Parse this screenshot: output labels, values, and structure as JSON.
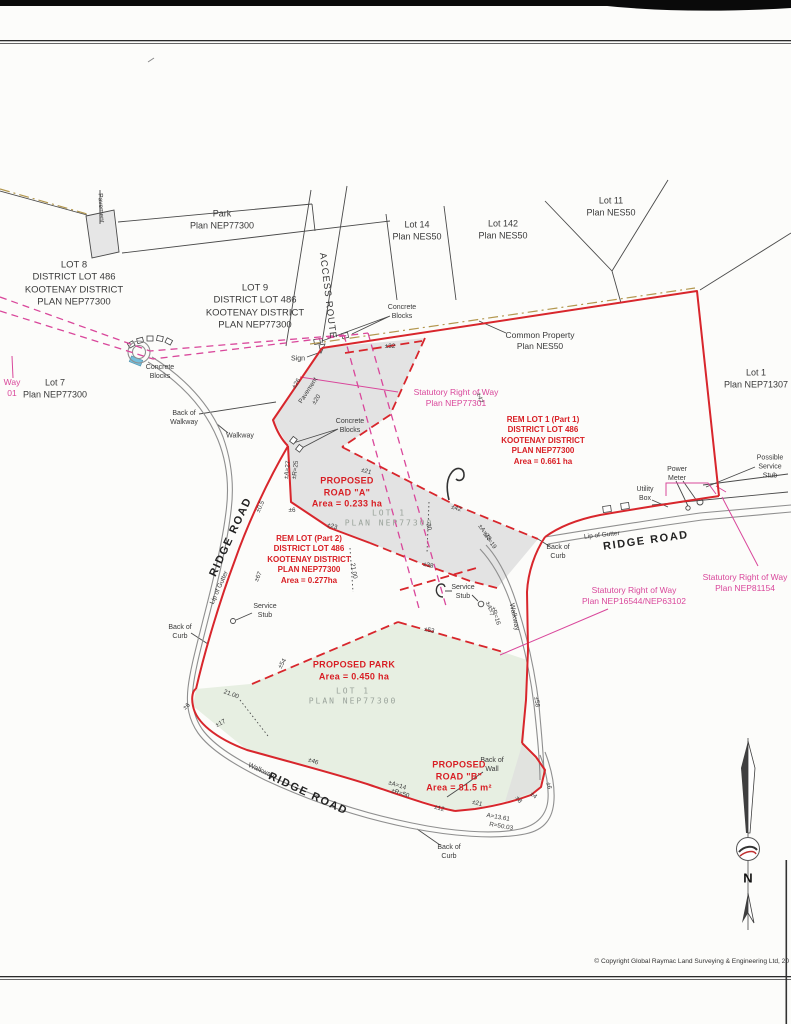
{
  "page": {
    "copyright": "© Copyright Global Raymac Land Surveying & Engineering Ltd, 20"
  },
  "colors": {
    "boundary_red": "#d8262c",
    "red_text": "#d81e24",
    "srw_magenta": "#d9479b",
    "park_green": "#e7efe2",
    "pavement_gray": "#e3e3e3",
    "road_gray": "#8f8f8f",
    "common_property_tan": "#b3974e",
    "culvert_blue": "#74bfdc"
  },
  "map": {
    "labels": [
      {
        "n": "lot8-label",
        "t": "LOT 8\nDISTRICT LOT 486\nKOOTENAY DISTRICT\nPLAN NEP77300",
        "x": 74,
        "y": 284,
        "r": 0,
        "c": "blk",
        "s": 9.5
      },
      {
        "n": "lot9-label",
        "t": "LOT 9\nDISTRICT LOT 486\nKOOTENAY DISTRICT\nPLAN NEP77300",
        "x": 255,
        "y": 307,
        "r": 0,
        "c": "blk",
        "s": 9.5
      },
      {
        "n": "park-plan-label",
        "t": "Park\nPlan NEP77300",
        "x": 222,
        "y": 220,
        "r": 0,
        "c": "blk",
        "s": 9
      },
      {
        "n": "lot14-label",
        "t": "Lot 14\nPlan NES50",
        "x": 417,
        "y": 231,
        "r": 0,
        "c": "blk",
        "s": 9
      },
      {
        "n": "lot142-label",
        "t": "Lot 142\nPlan NES50",
        "x": 503,
        "y": 230,
        "r": 0,
        "c": "blk",
        "s": 9
      },
      {
        "n": "lot11-label",
        "t": "Lot 11\nPlan NES50",
        "x": 611,
        "y": 207,
        "r": 0,
        "c": "blk",
        "s": 9
      },
      {
        "n": "lot7-label",
        "t": "Lot 7\nPlan NEP77300",
        "x": 55,
        "y": 389,
        "r": 0,
        "c": "blk",
        "s": 9
      },
      {
        "n": "lot1-nep71307-label",
        "t": "Lot 1\nPlan NEP71307",
        "x": 756,
        "y": 379,
        "r": 0,
        "c": "blk",
        "s": 9
      },
      {
        "n": "common-property-label",
        "t": "Common Property\nPlan NES50",
        "x": 540,
        "y": 341,
        "r": 0,
        "c": "blk",
        "s": 8.5
      },
      {
        "n": "access-route-label",
        "t": "ACCESS ROUTE",
        "x": 327,
        "y": 296,
        "r": 83,
        "c": "blk",
        "s": 9.5,
        "ls": 1
      },
      {
        "n": "pavement-label-top",
        "t": "Pavement",
        "x": 100,
        "y": 208,
        "r": 87,
        "c": "blk",
        "s": 6.5
      },
      {
        "n": "pavement-label-mid",
        "t": "Pavement",
        "x": 309,
        "y": 391,
        "r": -57,
        "c": "blk",
        "s": 6.5
      },
      {
        "n": "concrete-blocks-label-1",
        "t": "Concrete\nBlocks",
        "x": 160,
        "y": 372,
        "r": 0,
        "c": "blk",
        "s": 7
      },
      {
        "n": "concrete-blocks-label-2",
        "t": "Concrete\nBlocks",
        "x": 402,
        "y": 312,
        "r": 0,
        "c": "blk",
        "s": 7
      },
      {
        "n": "concrete-blocks-label-3",
        "t": "Concrete\nBlocks",
        "x": 350,
        "y": 426,
        "r": 0,
        "c": "blk",
        "s": 7
      },
      {
        "n": "sign-label",
        "t": "Sign",
        "x": 298,
        "y": 359,
        "r": 0,
        "c": "blk",
        "s": 7
      },
      {
        "n": "back-of-walkway-label",
        "t": "Back of\nWalkway",
        "x": 184,
        "y": 418,
        "r": 0,
        "c": "blk",
        "s": 7
      },
      {
        "n": "walkway-label-1",
        "t": "Walkway",
        "x": 240,
        "y": 436,
        "r": 0,
        "c": "blk",
        "s": 7
      },
      {
        "n": "walkway-label-2",
        "t": "Walkway",
        "x": 261,
        "y": 771,
        "r": 25,
        "c": "blk",
        "s": 7
      },
      {
        "n": "walkway-label-3",
        "t": "Walkway",
        "x": 514,
        "y": 617,
        "r": 78,
        "c": "blk",
        "s": 7
      },
      {
        "n": "ridge-road-label-left",
        "t": "RIDGE ROAD",
        "x": 231,
        "y": 537,
        "r": -65,
        "c": "road",
        "s": 11
      },
      {
        "n": "ridge-road-label-right",
        "t": "RIDGE ROAD",
        "x": 646,
        "y": 541,
        "r": -8,
        "c": "road",
        "s": 11
      },
      {
        "n": "ridge-road-label-bottom",
        "t": "RIDGE ROAD",
        "x": 308,
        "y": 794,
        "r": 25,
        "c": "road",
        "s": 11
      },
      {
        "n": "lip-of-gutter-label-left",
        "t": "Lip of Gutter",
        "x": 220,
        "y": 588,
        "r": -66,
        "c": "blk",
        "s": 6.5
      },
      {
        "n": "lip-of-gutter-label-right",
        "t": "Lip of Gutter",
        "x": 602,
        "y": 536,
        "r": -6,
        "c": "blk",
        "s": 6.5
      },
      {
        "n": "back-of-curb-label-left",
        "t": "Back of\nCurb",
        "x": 180,
        "y": 632,
        "r": 0,
        "c": "blk",
        "s": 7
      },
      {
        "n": "back-of-curb-label-right",
        "t": "Back of\nCurb",
        "x": 558,
        "y": 552,
        "r": 0,
        "c": "blk",
        "s": 7
      },
      {
        "n": "back-of-curb-label-bottom",
        "t": "Back of\nCurb",
        "x": 449,
        "y": 852,
        "r": 0,
        "c": "blk",
        "s": 7
      },
      {
        "n": "back-of-wall-label",
        "t": "Back of\nWall",
        "x": 492,
        "y": 765,
        "r": 0,
        "c": "blk",
        "s": 7
      },
      {
        "n": "service-stub-label-1",
        "t": "Service\nStub",
        "x": 265,
        "y": 611,
        "r": 0,
        "c": "blk",
        "s": 7
      },
      {
        "n": "service-stub-label-2",
        "t": "Service\nStub",
        "x": 463,
        "y": 592,
        "r": 0,
        "c": "blk",
        "s": 7
      },
      {
        "n": "power-meter-label",
        "t": "Power\nMeter",
        "x": 677,
        "y": 474,
        "r": 0,
        "c": "blk",
        "s": 7
      },
      {
        "n": "utility-box-label",
        "t": "Utility\nBox",
        "x": 645,
        "y": 494,
        "r": 0,
        "c": "blk",
        "s": 7
      },
      {
        "n": "possible-service-stub-label",
        "t": "Possible\nService\nStub",
        "x": 770,
        "y": 467,
        "r": 0,
        "c": "blk",
        "s": 7
      },
      {
        "n": "srw-nep77301-label",
        "t": "Statutory Right of Way\nPlan NEP77301",
        "x": 456,
        "y": 398,
        "r": 0,
        "c": "pink",
        "s": 8.5
      },
      {
        "n": "srw-nep81154-label",
        "t": "Statutory Right of Way\nPlan NEP81154",
        "x": 745,
        "y": 583,
        "r": 0,
        "c": "pink",
        "s": 8.5
      },
      {
        "n": "srw-nep16544-label",
        "t": "Statutory Right of Way\nPlan NEP16544/NEP63102",
        "x": 634,
        "y": 596,
        "r": 0,
        "c": "pink",
        "s": 8.5
      },
      {
        "n": "srw-partial-left-label",
        "t": "Way\n01",
        "x": 12,
        "y": 388,
        "r": 0,
        "c": "pink",
        "s": 8.5
      },
      {
        "n": "rem-lot-1-label",
        "t": "REM LOT 1 (Part 1)\nDISTRICT LOT 486\nKOOTENAY DISTRICT\nPLAN NEP77300\nArea = 0.661 ha",
        "x": 543,
        "y": 441,
        "r": 0,
        "c": "red",
        "s": 8
      },
      {
        "n": "proposed-road-a-label",
        "t": "PROPOSED\nROAD \"A\"\nArea = 0.233 ha",
        "x": 347,
        "y": 493,
        "r": 0,
        "c": "redbig",
        "s": 9
      },
      {
        "n": "rem-lot-2-label",
        "t": "REM LOT (Part 2)\nDISTRICT LOT 486\nKOOTENAY DISTRICT\nPLAN NEP77300\nArea = 0.277ha",
        "x": 309,
        "y": 560,
        "r": 0,
        "c": "red",
        "s": 8
      },
      {
        "n": "proposed-park-label",
        "t": "PROPOSED PARK\nArea = 0.450 ha",
        "x": 354,
        "y": 671,
        "r": 0,
        "c": "redbig",
        "s": 9
      },
      {
        "n": "proposed-road-b-label",
        "t": "PROPOSED\nROAD \"B\"\nArea = 81.5 m²",
        "x": 459,
        "y": 777,
        "r": 0,
        "c": "redbig",
        "s": 9
      },
      {
        "n": "lot1-road-a-ghost-label",
        "t": "LOT 1\nPLAN NEP77300",
        "x": 389,
        "y": 519,
        "r": 0,
        "c": "gray",
        "s": 8
      },
      {
        "n": "lot1-park-ghost-label",
        "t": "LOT 1\nPLAN NEP77300",
        "x": 353,
        "y": 697,
        "r": 0,
        "c": "gray",
        "s": 8
      },
      {
        "n": "north-letter",
        "t": "N",
        "x": 748,
        "y": 879,
        "r": 0,
        "c": "compass",
        "s": 13
      },
      {
        "n": "dim-26",
        "t": "±26",
        "x": 297,
        "y": 384,
        "r": -57,
        "c": "dim",
        "s": 6.3
      },
      {
        "n": "dim-32",
        "t": "±32",
        "x": 390,
        "y": 347,
        "r": 0,
        "c": "dim",
        "s": 6.3
      },
      {
        "n": "dim-47",
        "t": "±47",
        "x": 479,
        "y": 398,
        "r": 77,
        "c": "dim",
        "s": 6.3
      },
      {
        "n": "dim-20a",
        "t": "±20",
        "x": 317,
        "y": 400,
        "r": -57,
        "c": "dim",
        "s": 6.3
      },
      {
        "n": "dim-21a",
        "t": "±21",
        "x": 366,
        "y": 472,
        "r": 17,
        "c": "dim",
        "s": 6.3
      },
      {
        "n": "dim-42",
        "t": "±42",
        "x": 456,
        "y": 509,
        "r": 17,
        "c": "dim",
        "s": 6.3
      },
      {
        "n": "dim-23",
        "t": "±23",
        "x": 332,
        "y": 527,
        "r": 17,
        "c": "dim",
        "s": 6.3
      },
      {
        "n": "dim-6a",
        "t": "±6",
        "x": 292,
        "y": 511,
        "r": 0,
        "c": "dim",
        "s": 6.3
      },
      {
        "n": "dim-38",
        "t": "±38",
        "x": 428,
        "y": 566,
        "r": 12,
        "c": "dim",
        "s": 6.3
      },
      {
        "n": "dim-20b",
        "t": "20",
        "x": 428,
        "y": 527,
        "r": 80,
        "c": "dim",
        "s": 6.3
      },
      {
        "n": "dim-2100a",
        "t": "21.00",
        "x": 353,
        "y": 571,
        "r": 80,
        "c": "dim",
        "s": 6.3
      },
      {
        "n": "dim-67",
        "t": "±67",
        "x": 259,
        "y": 577,
        "r": -65,
        "c": "dim",
        "s": 6.3
      },
      {
        "n": "dim-05",
        "t": "±0.5",
        "x": 261,
        "y": 507,
        "r": -65,
        "c": "dim",
        "s": 6.3
      },
      {
        "n": "dim-a27",
        "t": "±A=27",
        "x": 288,
        "y": 470,
        "r": -83,
        "c": "dim",
        "s": 6.3
      },
      {
        "n": "dim-r25",
        "t": "±R=25",
        "x": 296,
        "y": 470,
        "r": -83,
        "c": "dim",
        "s": 6.3
      },
      {
        "n": "dim-a23",
        "t": "±A=23",
        "x": 484,
        "y": 533,
        "r": 55,
        "c": "dim",
        "s": 6.3
      },
      {
        "n": "dim-r19",
        "t": "±R=19",
        "x": 489,
        "y": 541,
        "r": 55,
        "c": "dim",
        "s": 6.3
      },
      {
        "n": "dim-a7",
        "t": "±A=7",
        "x": 489,
        "y": 609,
        "r": 72,
        "c": "dim",
        "s": 6.3
      },
      {
        "n": "dim-r16",
        "t": "±R=16",
        "x": 495,
        "y": 616,
        "r": 72,
        "c": "dim",
        "s": 6.3
      },
      {
        "n": "dim-53",
        "t": "±53",
        "x": 429,
        "y": 631,
        "r": 12,
        "c": "dim",
        "s": 6.3
      },
      {
        "n": "dim-54",
        "t": "±54",
        "x": 283,
        "y": 664,
        "r": -60,
        "c": "dim",
        "s": 6.3
      },
      {
        "n": "dim-58",
        "t": "±58",
        "x": 536,
        "y": 702,
        "r": 82,
        "c": "dim",
        "s": 6.3
      },
      {
        "n": "dim-6b",
        "t": "±6",
        "x": 187,
        "y": 707,
        "r": -40,
        "c": "dim",
        "s": 6.3
      },
      {
        "n": "dim-17",
        "t": "±17",
        "x": 221,
        "y": 724,
        "r": -28,
        "c": "dim",
        "s": 6.3
      },
      {
        "n": "dim-46",
        "t": "±46",
        "x": 313,
        "y": 762,
        "r": 20,
        "c": "dim",
        "s": 6.3
      },
      {
        "n": "dim-a14",
        "t": "±A=14",
        "x": 397,
        "y": 786,
        "r": 18,
        "c": "dim",
        "s": 6.3
      },
      {
        "n": "dim-r50",
        "t": "±R=50",
        "x": 400,
        "y": 794,
        "r": 18,
        "c": "dim",
        "s": 6.3
      },
      {
        "n": "dim-12",
        "t": "±12",
        "x": 439,
        "y": 809,
        "r": 17,
        "c": "dim",
        "s": 6.3
      },
      {
        "n": "dim-21b",
        "t": "±21",
        "x": 477,
        "y": 804,
        "r": 15,
        "c": "dim",
        "s": 6.3
      },
      {
        "n": "dim-a1361",
        "t": "A=13.61",
        "x": 498,
        "y": 818,
        "r": 10,
        "c": "dim",
        "s": 6.3
      },
      {
        "n": "dim-r5003",
        "t": "R=50.03",
        "x": 501,
        "y": 827,
        "r": 10,
        "c": "dim",
        "s": 6.3
      },
      {
        "n": "dim-8",
        "t": "±8",
        "x": 518,
        "y": 800,
        "r": 55,
        "c": "dim",
        "s": 6.3
      },
      {
        "n": "dim-6c",
        "t": "±6",
        "x": 548,
        "y": 786,
        "r": 78,
        "c": "dim",
        "s": 6.3
      },
      {
        "n": "dim-4",
        "t": "±4",
        "x": 533,
        "y": 796,
        "r": 40,
        "c": "dim",
        "s": 6.3
      },
      {
        "n": "dim-2100b",
        "t": "21.00",
        "x": 231,
        "y": 695,
        "r": 20,
        "c": "dim",
        "s": 6.3
      }
    ]
  }
}
